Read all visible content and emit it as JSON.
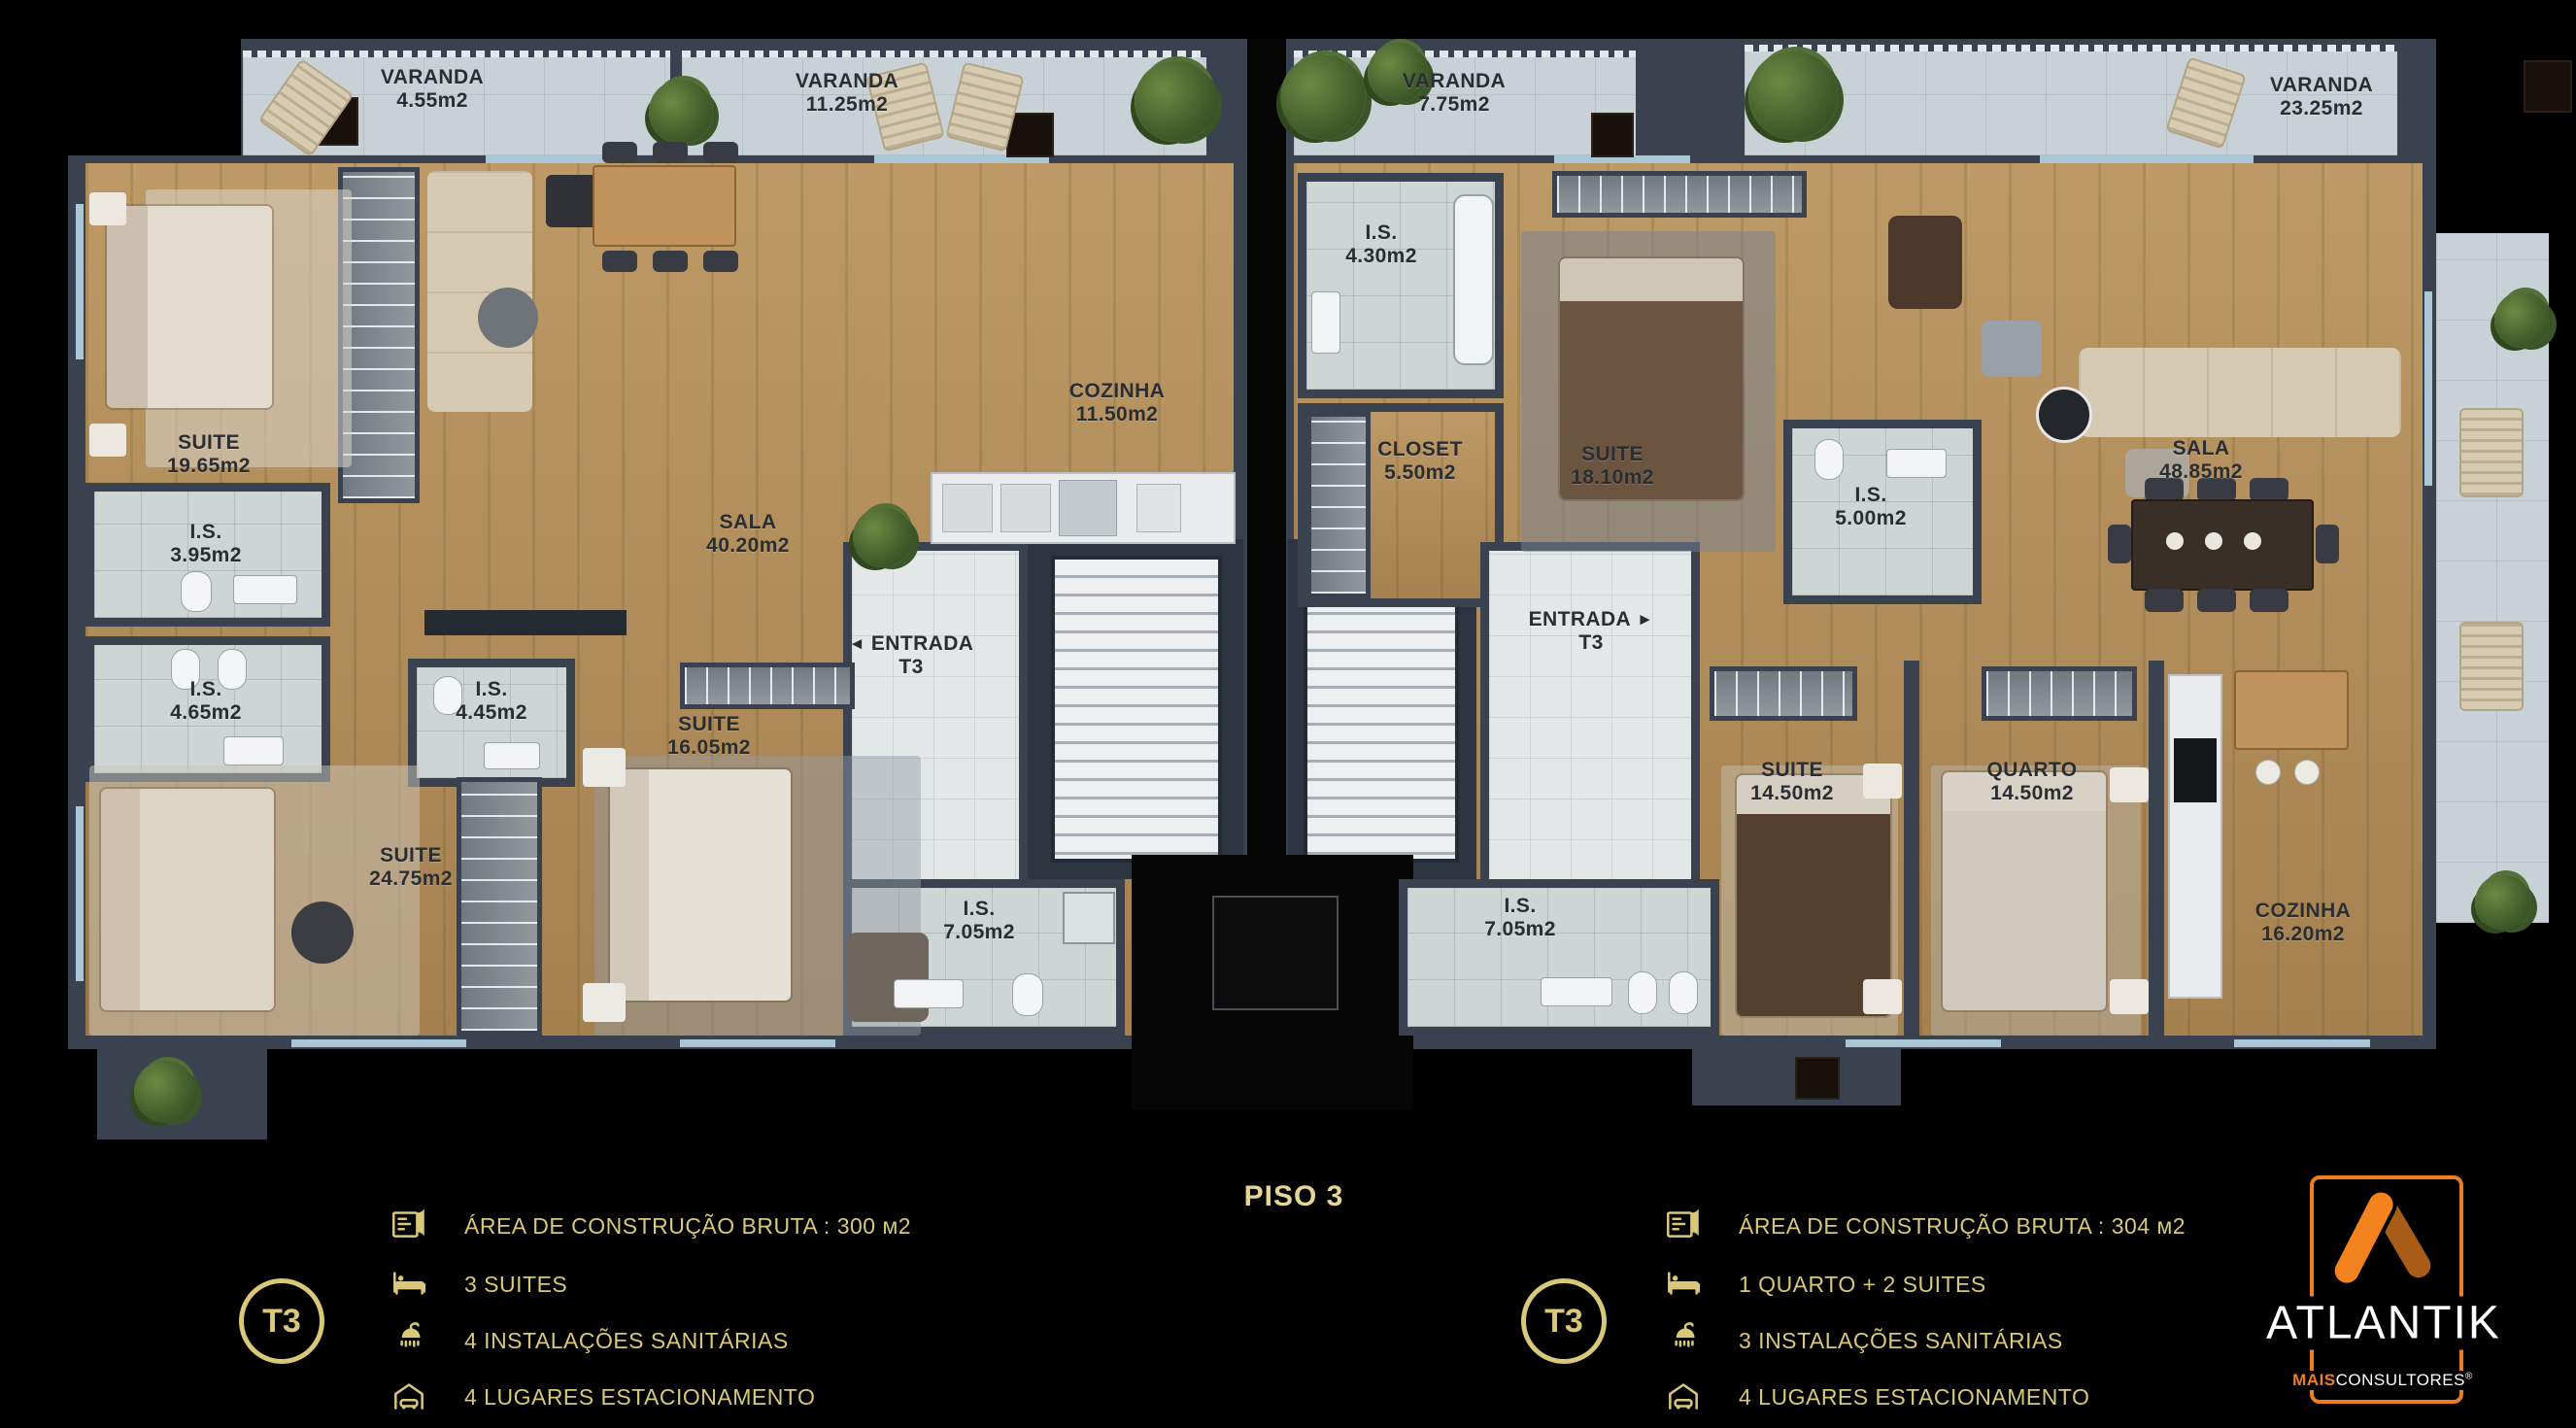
{
  "floor_title": "PISO 3",
  "colors": {
    "accent_gold": "#D9C878",
    "brand_orange": "#EF7D22",
    "brand_orange_dark": "#A85C17",
    "wall": "#39424E",
    "wood_floor": "#B5905A"
  },
  "balconies": [
    {
      "name": "VARANDA",
      "area": "4.55m2"
    },
    {
      "name": "VARANDA",
      "area": "11.25m2"
    },
    {
      "name": "VARANDA",
      "area": "7.75m2"
    },
    {
      "name": "VARANDA",
      "area": "23.25m2"
    }
  ],
  "apartment_left": {
    "rooms": [
      {
        "name": "SUITE",
        "area": "19.65m2"
      },
      {
        "name": "I.S.",
        "area": "3.95m2"
      },
      {
        "name": "I.S.",
        "area": "4.65m2"
      },
      {
        "name": "I.S.",
        "area": "4.45m2"
      },
      {
        "name": "SUITE",
        "area": "16.05m2"
      },
      {
        "name": "SUITE",
        "area": "24.75m2"
      },
      {
        "name": "SALA",
        "area": "40.20m2"
      },
      {
        "name": "COZINHA",
        "area": "11.50m2"
      },
      {
        "name": "ENTRADA",
        "area": "T3"
      },
      {
        "name": "I.S.",
        "area": "7.05m2"
      }
    ]
  },
  "apartment_right": {
    "rooms": [
      {
        "name": "I.S.",
        "area": "4.30m2"
      },
      {
        "name": "CLOSET",
        "area": "5.50m2"
      },
      {
        "name": "SUITE",
        "area": "18.10m2"
      },
      {
        "name": "I.S.",
        "area": "5.00m2"
      },
      {
        "name": "SALA",
        "area": "48.85m2"
      },
      {
        "name": "ENTRADA",
        "area": "T3"
      },
      {
        "name": "SUITE",
        "area": "14.50m2"
      },
      {
        "name": "QUARTO",
        "area": "14.50m2"
      },
      {
        "name": "COZINHA",
        "area": "16.20m2"
      },
      {
        "name": "I.S.",
        "area": "7.05m2"
      }
    ]
  },
  "entrance_arrows": {
    "left": "◄",
    "right": "►"
  },
  "legend_left": {
    "badge": "T3",
    "rows": [
      {
        "icon": "floorplan-icon",
        "text": "ÁREA DE CONSTRUÇÃO BRUTA :  300 м2"
      },
      {
        "icon": "bed-icon",
        "text": "3 SUITES"
      },
      {
        "icon": "shower-icon",
        "text": "4 INSTALAÇÕES SANITÁRIAS"
      },
      {
        "icon": "garage-icon",
        "text": "4 LUGARES ESTACIONAMENTO"
      }
    ]
  },
  "legend_right": {
    "badge": "T3",
    "rows": [
      {
        "icon": "floorplan-icon",
        "text": "ÁREA DE CONSTRUÇÃO BRUTA :  304 м2"
      },
      {
        "icon": "bed-icon",
        "text": "1 QUARTO + 2 SUITES"
      },
      {
        "icon": "shower-icon",
        "text": "3 INSTALAÇÕES SANITÁRIAS"
      },
      {
        "icon": "garage-icon",
        "text": "4 LUGARES ESTACIONAMENTO"
      }
    ]
  },
  "logo": {
    "brand": "ATLANTIK",
    "tagline_bold": "MAIS",
    "tagline_regular": "CONSULTORES",
    "registered": "®"
  }
}
